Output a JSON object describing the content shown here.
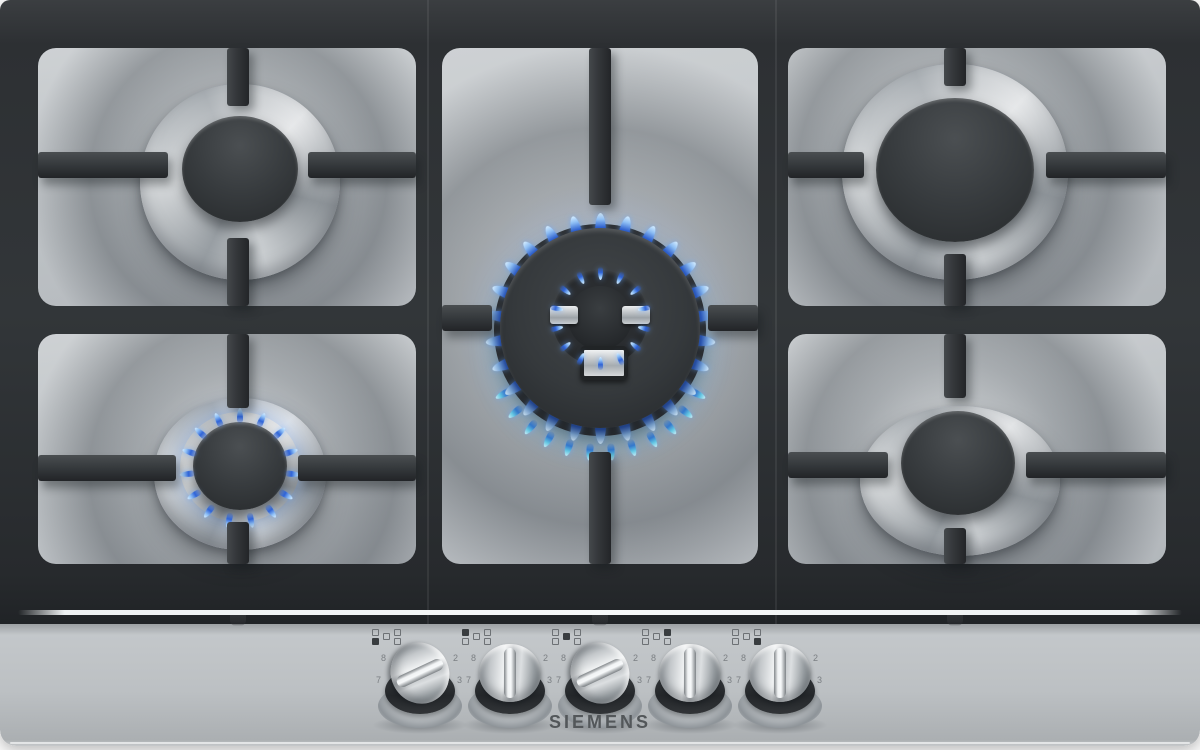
{
  "brand": {
    "logo": "SIEMENS"
  },
  "appliance": "5-burner stainless steel gas hob",
  "colors": {
    "steel_light": "#c6cacd",
    "steel_mid": "#b2b7ba",
    "grate_dark": "#313437",
    "flame_blue": "#2f64d8",
    "flame_tip": "#d4ecff",
    "flame_teal": "#62cdea",
    "logo_text": "#53575a"
  },
  "burners": {
    "top_left": {
      "name": "top-left burner",
      "size": "standard",
      "state": "off"
    },
    "bottom_left": {
      "name": "bottom-left burner",
      "size": "standard",
      "state": "on",
      "flames": {
        "count": 15,
        "radius": 53,
        "len": 15,
        "dir": "out",
        "start": 0,
        "end": 360,
        "style": "main"
      }
    },
    "center": {
      "name": "center wok burner",
      "size": "wok",
      "state": "on",
      "outer_flames": {
        "count": 26,
        "radius": 103,
        "len": 25,
        "dir": "out",
        "start": 0,
        "end": 360,
        "style": "main"
      },
      "lower_flames": {
        "count": 12,
        "radius": 110,
        "len": 17,
        "dir": "out",
        "start": 118,
        "end": 242,
        "style": "teal"
      },
      "inner_flames": {
        "count": 14,
        "radius": 45,
        "len": 13,
        "dir": "in",
        "start": 0,
        "end": 360,
        "style": "main"
      }
    },
    "top_right": {
      "name": "top-right burner",
      "size": "rapid",
      "state": "off"
    },
    "bottom_right": {
      "name": "bottom-right burner",
      "size": "standard",
      "state": "off"
    }
  },
  "panel": {
    "knobs": [
      {
        "id": "1",
        "controls": "bottom-left burner",
        "indicator_filled": "bottom-left",
        "state": "on",
        "angle_deg": 65,
        "scale": [
          "8",
          "7",
          "6",
          "5",
          "4",
          "3",
          "2"
        ]
      },
      {
        "id": "2",
        "controls": "top-left burner",
        "indicator_filled": "top-left",
        "state": "off",
        "angle_deg": 0,
        "scale": [
          "8",
          "7",
          "6",
          "5",
          "4",
          "3",
          "2"
        ]
      },
      {
        "id": "3",
        "controls": "center wok burner",
        "indicator_filled": "center",
        "state": "on",
        "angle_deg": 65,
        "scale": [
          "8",
          "7",
          "6",
          "5",
          "4",
          "3",
          "2"
        ]
      },
      {
        "id": "4",
        "controls": "top-right burner",
        "indicator_filled": "top-right",
        "state": "off",
        "angle_deg": 0,
        "scale": [
          "8",
          "7",
          "6",
          "5",
          "4",
          "3",
          "2"
        ]
      },
      {
        "id": "5",
        "controls": "bottom-right burner",
        "indicator_filled": "bottom-right",
        "state": "off",
        "angle_deg": 0,
        "scale": [
          "8",
          "7",
          "6",
          "5",
          "4",
          "3",
          "2"
        ]
      }
    ],
    "knob_positions_x": [
      420,
      510,
      600,
      690,
      780
    ]
  }
}
